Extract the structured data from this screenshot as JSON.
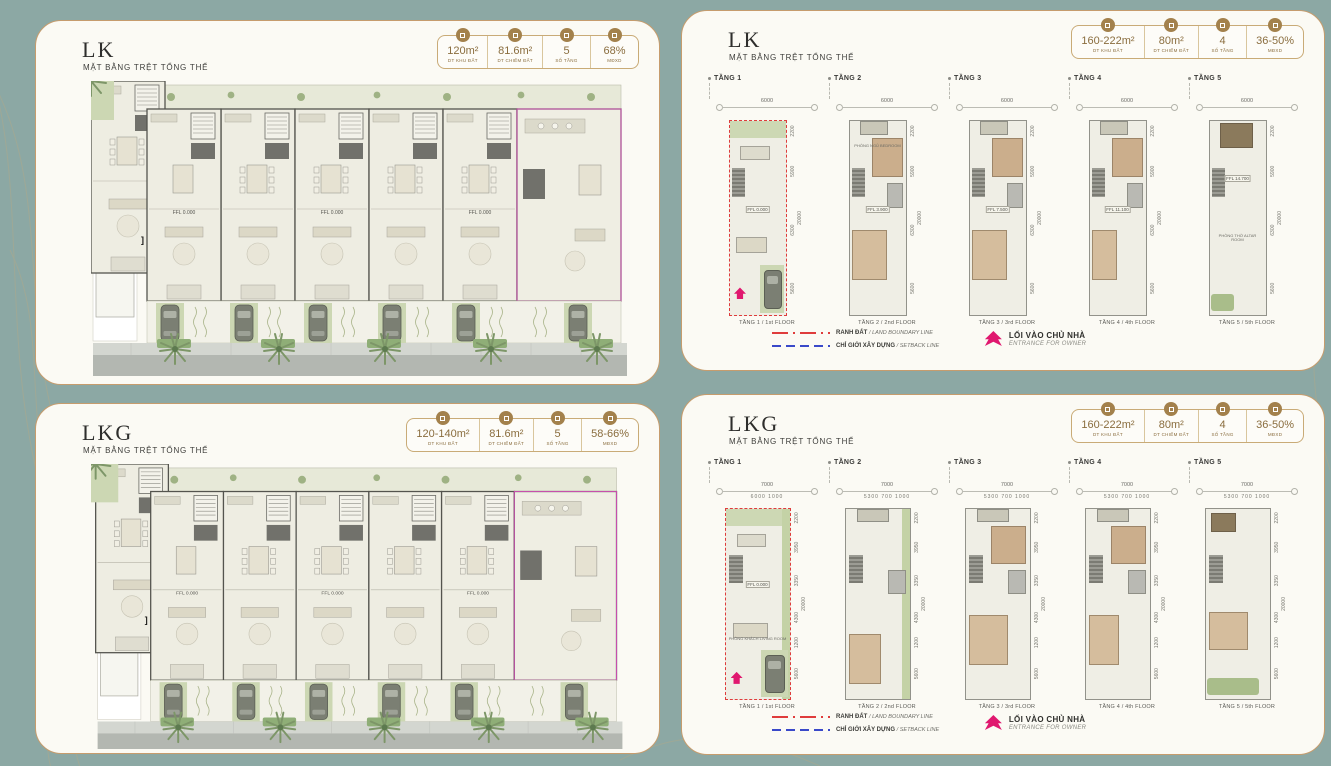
{
  "background": {
    "teal": "#8ca8a4",
    "panel_cream": "#fbfaf4",
    "gold_border": "#c69c6d",
    "accent_gold": "#a3814c",
    "boundary_red": "#df3c3c",
    "setback_blue": "#3a49c9",
    "entrance_magenta": "#e0186f"
  },
  "panels": [
    {
      "title": "LK",
      "subtitle": "MẶT BẰNG TRỆT TỔNG THỂ",
      "type": "site-plan",
      "stats": [
        {
          "icon": "land-area-icon",
          "value": "120m²",
          "label": "DT KHU ĐẤT"
        },
        {
          "icon": "footprint-area-icon",
          "value": "81.6m²",
          "label": "DT CHIẾM ĐẤT"
        },
        {
          "icon": "floor-count-icon",
          "value": "5",
          "label": "SỐ TẦNG"
        },
        {
          "icon": "build-density-icon",
          "value": "68%",
          "label": "MĐXD"
        }
      ],
      "plan_note": "FFL 0.000"
    },
    {
      "title": "LK",
      "subtitle": "MẶT BẰNG TRỆT TỔNG THỂ",
      "type": "floor-plans",
      "stats": [
        {
          "icon": "land-area-icon",
          "value": "160-222m²",
          "label": "DT KHU ĐẤT"
        },
        {
          "icon": "footprint-area-icon",
          "value": "80m²",
          "label": "DT CHIẾM ĐẤT"
        },
        {
          "icon": "floor-count-icon",
          "value": "4",
          "label": "SỐ TẦNG"
        },
        {
          "icon": "build-density-icon",
          "value": "36-50%",
          "label": "MĐXD"
        }
      ],
      "floors": [
        {
          "label": "TẦNG 1",
          "top_dim": "6000",
          "sub_dims": "",
          "ffl": "FFL 0.000",
          "caption": "TẦNG 1 / 1st FLOOR",
          "room": ""
        },
        {
          "label": "TẦNG 2",
          "top_dim": "6000",
          "sub_dims": "",
          "ffl": "FFL 3.900",
          "caption": "TẦNG 2 / 2nd FLOOR",
          "room": "PHÒNG NGỦ BEDROOM"
        },
        {
          "label": "TẦNG 3",
          "top_dim": "6000",
          "sub_dims": "",
          "ffl": "FFL 7.500",
          "caption": "TẦNG 3 / 3rd FLOOR",
          "room": "PHÒNG NGỦ BEDROOM"
        },
        {
          "label": "TẦNG 4",
          "top_dim": "6000",
          "sub_dims": "",
          "ffl": "FFL 11.100",
          "caption": "TẦNG 4 / 4th FLOOR",
          "room": ""
        },
        {
          "label": "TẦNG 5",
          "top_dim": "6000",
          "sub_dims": "",
          "ffl": "FFL 14.700",
          "caption": "TẦNG 5 / 5th FLOOR",
          "room": "PHÒNG THỜ ALTAR ROOM"
        }
      ],
      "side_dims": [
        "2200",
        "5900",
        "6300",
        "5600"
      ],
      "total_dim": "20000",
      "legend": {
        "boundary_label": "RANH ĐẤT",
        "boundary_sub": "/ LAND BOUNDARY LINE",
        "setback_label": "CHỈ GIỚI XÂY DỰNG",
        "setback_sub": "/ SETBACK LINE",
        "entrance_title": "LỐI VÀO CHỦ NHÀ",
        "entrance_sub": "ENTRANCE FOR OWNER"
      }
    },
    {
      "title": "LKG",
      "subtitle": "MẶT BẰNG TRỆT TỔNG THỂ",
      "type": "site-plan",
      "stats": [
        {
          "icon": "land-area-icon",
          "value": "120-140m²",
          "label": "DT KHU ĐẤT"
        },
        {
          "icon": "footprint-area-icon",
          "value": "81.6m²",
          "label": "DT CHIẾM ĐẤT"
        },
        {
          "icon": "floor-count-icon",
          "value": "5",
          "label": "SỐ TẦNG"
        },
        {
          "icon": "build-density-icon",
          "value": "58-66%",
          "label": "MĐXD"
        }
      ],
      "plan_note": "FFL 0.000"
    },
    {
      "title": "LKG",
      "subtitle": "MẶT BẰNG TRỆT TỔNG THỂ",
      "type": "floor-plans",
      "stats": [
        {
          "icon": "land-area-icon",
          "value": "160-222m²",
          "label": "DT KHU ĐẤT"
        },
        {
          "icon": "footprint-area-icon",
          "value": "80m²",
          "label": "DT CHIẾM ĐẤT"
        },
        {
          "icon": "floor-count-icon",
          "value": "4",
          "label": "SỐ TẦNG"
        },
        {
          "icon": "build-density-icon",
          "value": "36-50%",
          "label": "MĐXD"
        }
      ],
      "floors": [
        {
          "label": "TẦNG 1",
          "top_dim": "7000",
          "sub_dims": "6000  1000",
          "ffl": "FFL 0.000",
          "caption": "TẦNG 1 / 1st FLOOR",
          "room": "PHÒNG KHÁCH LIVING ROOM"
        },
        {
          "label": "TẦNG 2",
          "top_dim": "7000",
          "sub_dims": "5300  700 1000",
          "ffl": "",
          "caption": "TẦNG 2 / 2nd FLOOR",
          "room": ""
        },
        {
          "label": "TẦNG 3",
          "top_dim": "7000",
          "sub_dims": "5300  700 1000",
          "ffl": "",
          "caption": "TẦNG 3 / 3rd FLOOR",
          "room": ""
        },
        {
          "label": "TẦNG 4",
          "top_dim": "7000",
          "sub_dims": "5300  700 1000",
          "ffl": "",
          "caption": "TẦNG 4 / 4th FLOOR",
          "room": ""
        },
        {
          "label": "TẦNG 5",
          "top_dim": "7000",
          "sub_dims": "5300  700 1000",
          "ffl": "",
          "caption": "TẦNG 5 / 5th FLOOR",
          "room": ""
        }
      ],
      "side_dims": [
        "2200",
        "3950",
        "3350",
        "4300",
        "1200",
        "5600"
      ],
      "total_dim": "20000",
      "legend": {
        "boundary_label": "RANH ĐẤT",
        "boundary_sub": "/ LAND BOUNDARY LINE",
        "setback_label": "CHỈ GIỚI XÂY DỰNG",
        "setback_sub": "/ SETBACK LINE",
        "entrance_title": "LỐI VÀO CHỦ NHÀ",
        "entrance_sub": "ENTRANCE FOR OWNER"
      }
    }
  ]
}
